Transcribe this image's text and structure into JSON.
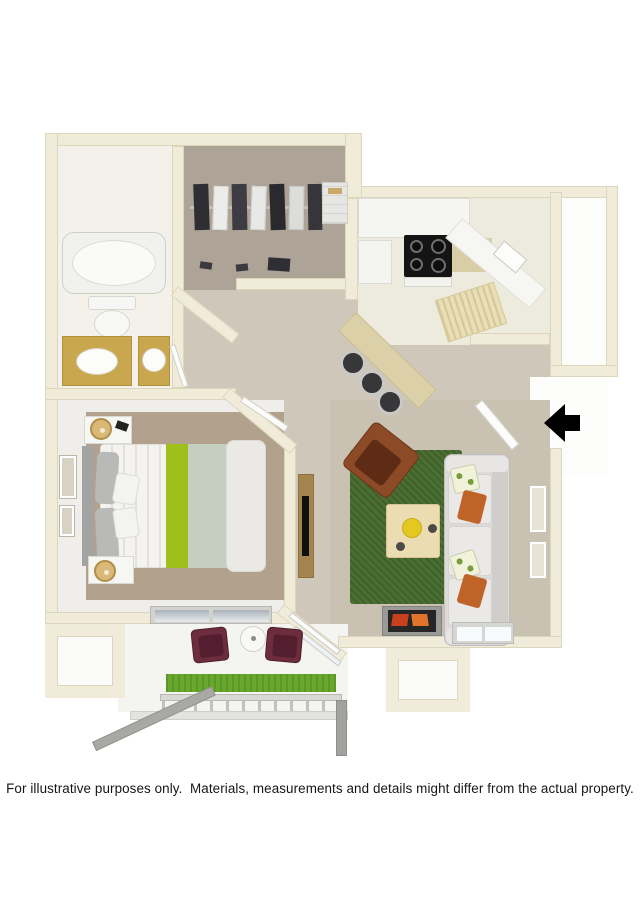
{
  "disclaimer": "For illustrative purposes only.  Materials, measurements and details might differ from the actual property.",
  "floor_plan": {
    "type": "3d-rendered-apartment-floor-plan",
    "view": "top-down dollhouse render",
    "entry_arrow": {
      "direction": "left",
      "color": "#000000"
    },
    "rooms": [
      {
        "name": "bathroom",
        "features": [
          "bathtub",
          "toilet",
          "gold-vanity-oval-sink",
          "gold-vanity-round-sink",
          "tile-floor"
        ]
      },
      {
        "name": "walk-in-closet",
        "features": [
          "hanging-rod",
          "hanging-clothes",
          "shoes",
          "shelf-stack"
        ]
      },
      {
        "name": "kitchen",
        "features": [
          "black-cooktop-range",
          "white-cabinets",
          "speckled-counter",
          "angled-counter-with-sink",
          "breakfast-bar",
          "three-black-bar-stools",
          "tile-floor"
        ]
      },
      {
        "name": "hallway",
        "features": [
          "beige-carpet",
          "tv-console-with-flat-tv"
        ]
      },
      {
        "name": "bedroom",
        "features": [
          "bed-white-striped-linens",
          "lime-green-runner",
          "sage-blanket",
          "fur-throw",
          "gray-headboard",
          "two-nightstands",
          "two-gold-lamps",
          "wall-art-frames",
          "window"
        ]
      },
      {
        "name": "living-room",
        "features": [
          "green-shag-rug",
          "rust-brown-accent-chair",
          "wood-coffee-table-yellow-bowl",
          "gray-sofa",
          "orange-pillows",
          "leaf-print-pillows",
          "wall-art-frames",
          "fireplace",
          "window"
        ]
      },
      {
        "name": "patio",
        "features": [
          "two-burgundy-chairs",
          "round-side-table",
          "grass-planter-strip",
          "railing-with-slats",
          "support-beams"
        ]
      },
      {
        "name": "storage-room",
        "features": []
      },
      {
        "name": "entry",
        "features": [
          "open-door",
          "black-entry-arrow"
        ]
      }
    ],
    "colors": {
      "background": "#ffffff",
      "walls_cream": "#f0ecd9",
      "wall_edge": "#dcd6bc",
      "hall_carpet": "#cfc8ba",
      "bedroom_carpet": "#b2a28d",
      "living_carpet": "#c9c1b1",
      "closet_carpet": "#ada396",
      "rug_green": "#4b6f32",
      "grass_green": "#68a72d",
      "accent_lime": "#9fc01b",
      "sage_blanket": "#c4cec1",
      "accent_chair_brown": "#8d4a27",
      "patio_chair_burgundy": "#6d2d3f",
      "vanity_gold": "#c9a74f",
      "cooktop_black": "#141414",
      "counter_beige": "#dcd0a8",
      "sofa_gray": "#dcdbd9",
      "pillow_orange": "#c06329",
      "wood_console": "#a4854f",
      "text_color": "#161616"
    }
  }
}
